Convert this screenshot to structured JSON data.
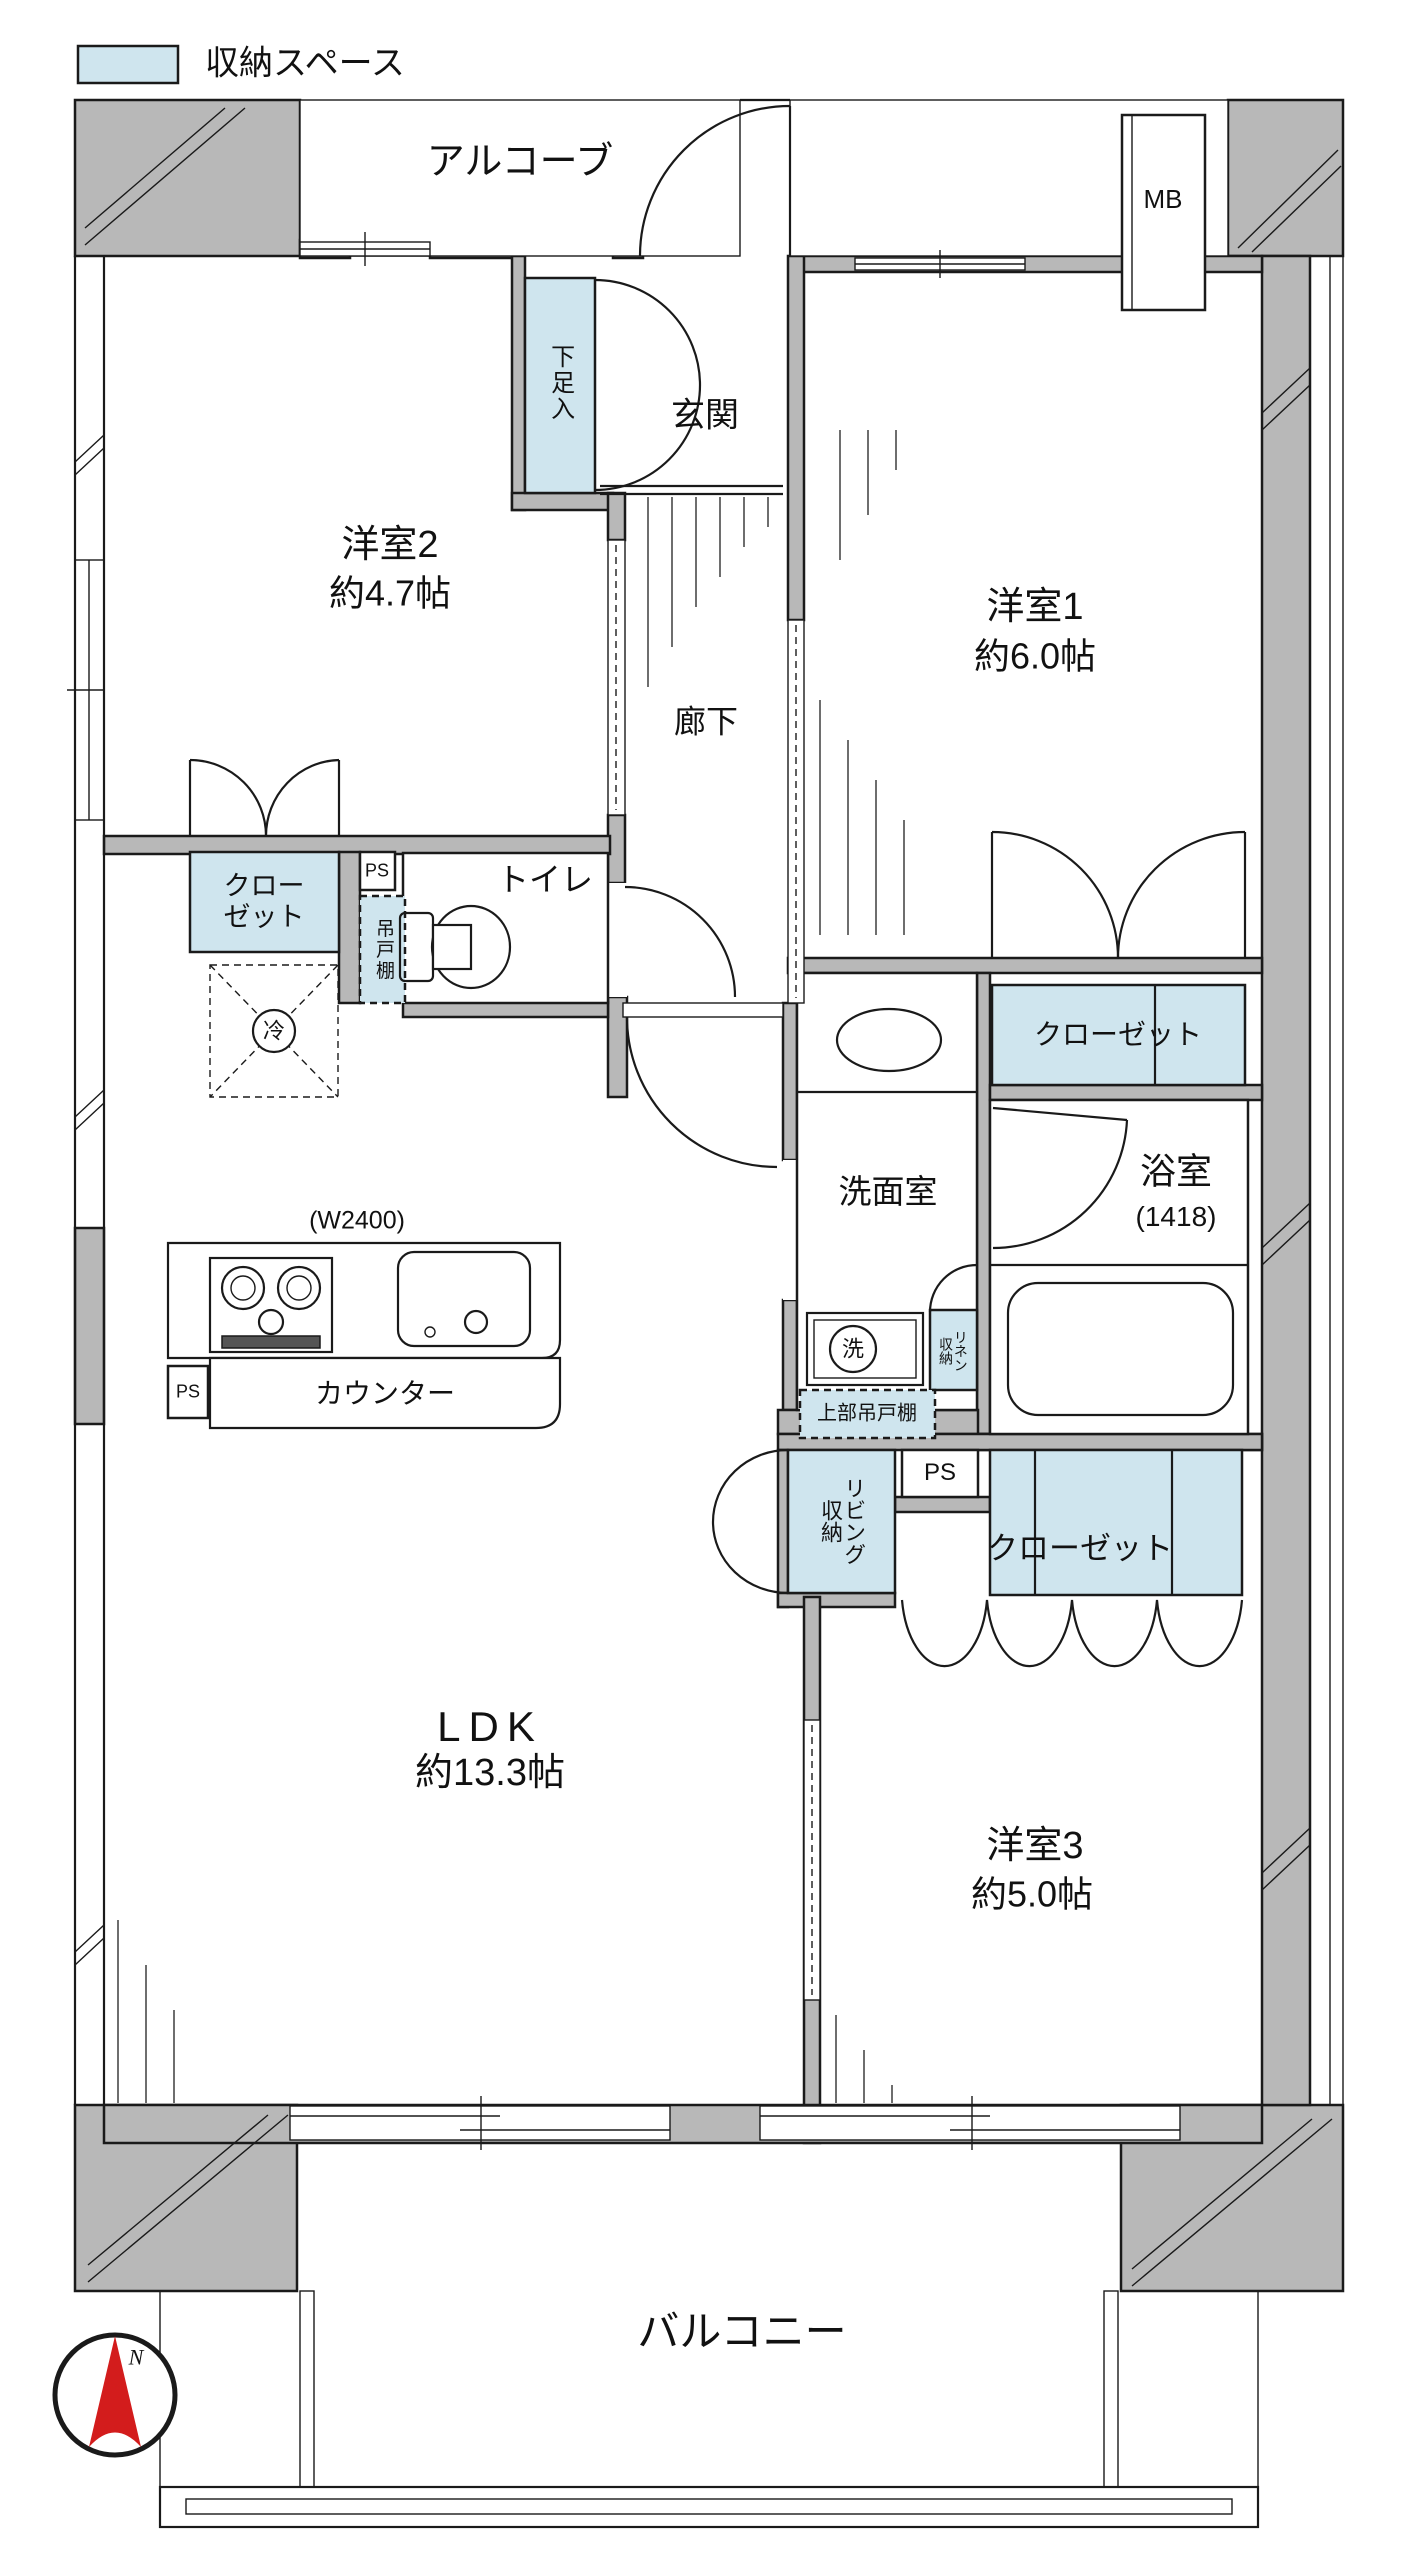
{
  "colors": {
    "storage": "#cfe5ee",
    "wall": "#b8b8b8",
    "accent_red": "#d31c1c"
  },
  "legend": {
    "label": "収納スペース"
  },
  "compass": {
    "north": "N"
  },
  "outdoor": {
    "alcove": "アルコーブ",
    "balcony": "バルコニー",
    "meter_box": "MB"
  },
  "rooms": {
    "entrance": "玄関",
    "hallway": "廊下",
    "toilet": "トイレ",
    "washroom": "洗面室",
    "room1": {
      "name": "洋室1",
      "size": "約6.0帖"
    },
    "room2": {
      "name": "洋室2",
      "size": "約4.7帖"
    },
    "room3": {
      "name": "洋室3",
      "size": "約5.0帖"
    },
    "ldk": {
      "name": "LDK",
      "size": "約13.3帖"
    },
    "bathroom": {
      "name": "浴室",
      "size": "(1418)"
    }
  },
  "storage": {
    "shoe_cabinet": "下足入",
    "closet": "クローゼット",
    "hanging_cupboard": "吊戸棚",
    "linen": "リネン収納",
    "upper_hanging_cupboard": "上部吊戸棚",
    "living_storage": "リビング収納"
  },
  "kitchen": {
    "counter": "カウンター",
    "counter_width": "(W2400)",
    "fridge": "冷",
    "washer": "洗"
  },
  "utility": {
    "pipe_space": "PS"
  }
}
